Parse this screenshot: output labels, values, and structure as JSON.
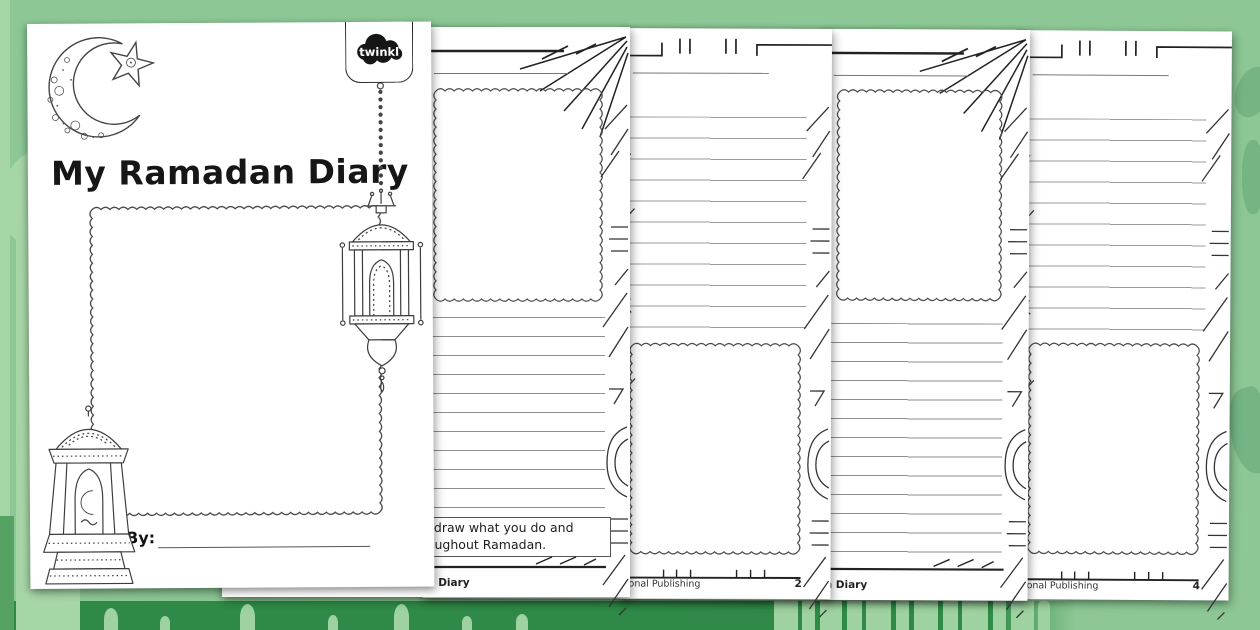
{
  "colors": {
    "background": "#8CC795",
    "bottom_band": "#2E8A46",
    "silhouette_light": "#A6D5A6",
    "silhouette_dark": "#74B583",
    "page": "#FFFFFF",
    "ink": "#222222",
    "rule_line": "#8E8E8E"
  },
  "cover": {
    "title": "My Ramadan Diary",
    "by_label": "By:",
    "logo_text": "twinkl"
  },
  "sheets": {
    "page2": {
      "note_line1": "d draw what you do and",
      "note_line2": "roughout Ramadan.",
      "footer_left": "an Diary"
    },
    "page3": {
      "footer_left": "onal Publishing",
      "page_number": "2"
    },
    "page4": {
      "footer_left": "an Diary"
    },
    "page5": {
      "footer_left": "onal Publishing",
      "page_number": "4"
    }
  }
}
